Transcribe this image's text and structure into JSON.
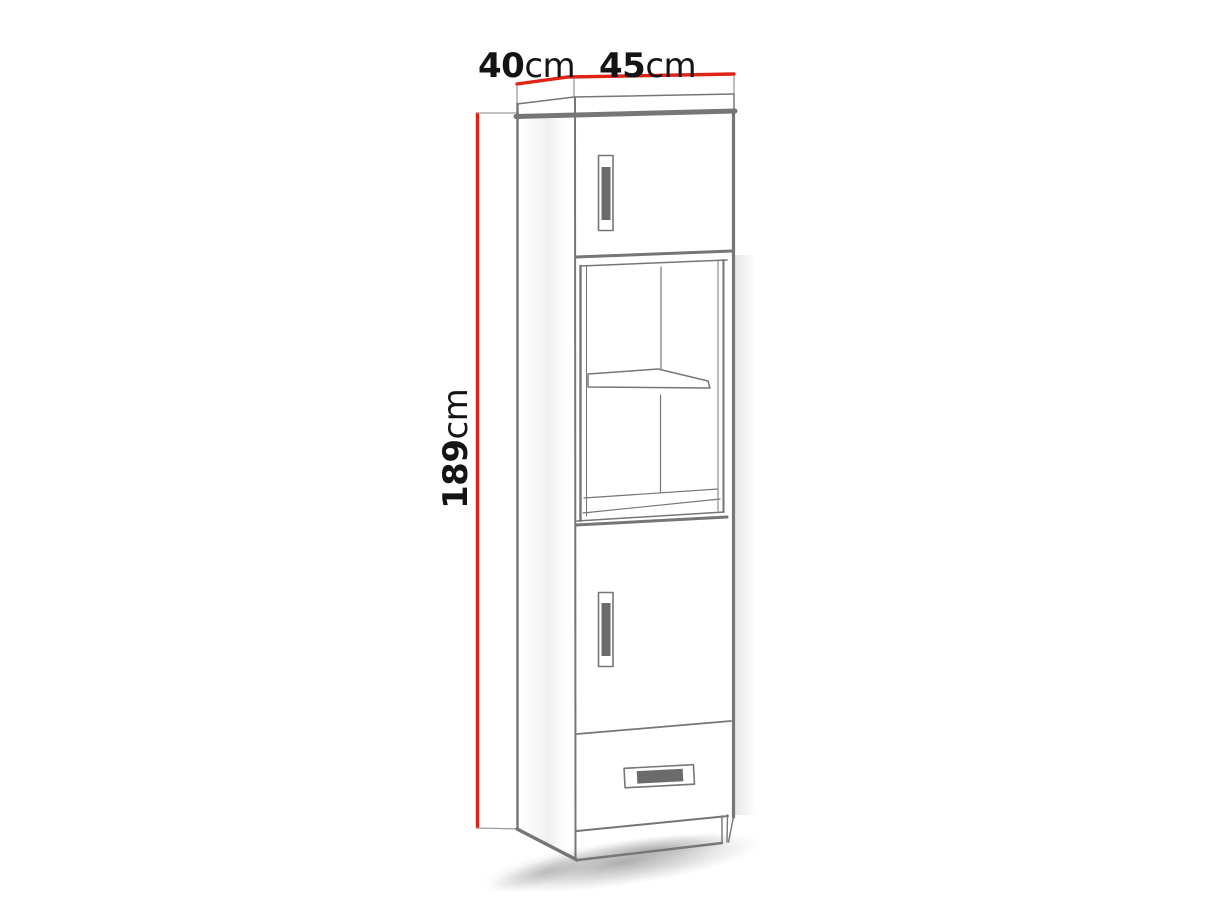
{
  "page": {
    "background": "#ffffff"
  },
  "diagram": {
    "labels": {
      "depth": {
        "value": "40",
        "unit": "cm"
      },
      "width": {
        "value": "45",
        "unit": "cm"
      },
      "height": {
        "value": "189",
        "unit": "cm"
      }
    },
    "colors": {
      "dimension_line": "#e02314",
      "extension_line": "#9c9c9c",
      "outline": "#767676",
      "handle_fill": "#6b6b6b",
      "label_text": "#141414"
    }
  }
}
